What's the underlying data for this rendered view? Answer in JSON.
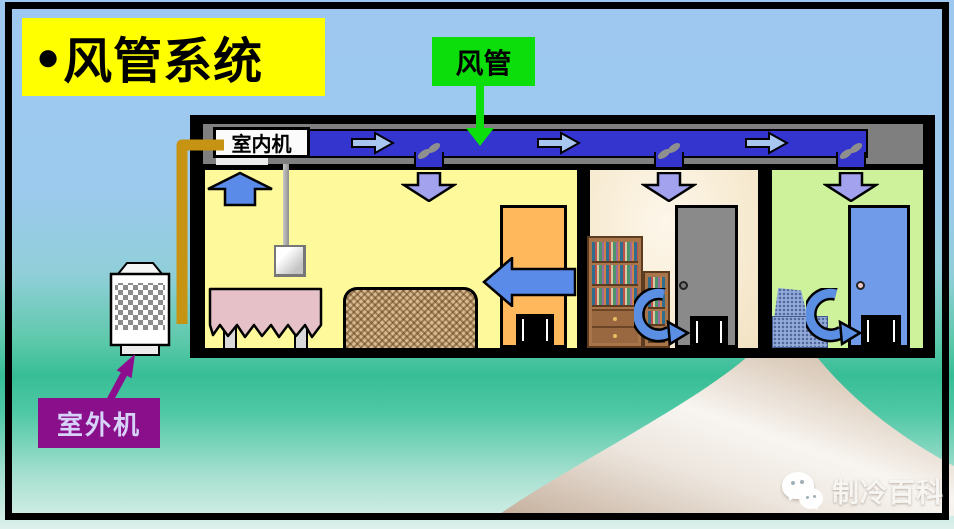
{
  "slide": {
    "title": {
      "bullet": "●",
      "text": "风管系统"
    },
    "callouts": {
      "duct": "风管",
      "indoor_unit": "室内机",
      "outdoor_unit": "室外机"
    },
    "watermark": "制冷百科",
    "icons": {
      "duct_airflow": "right-arrow",
      "supply_vent": "down-arrow",
      "return_air": "up-arrow",
      "room_return": "left-arrow",
      "door_airflow": "curved-arrow",
      "damper": "s-damper",
      "watermark_logo": "wechat-bubbles"
    },
    "colors": {
      "sky": "#9EC8F0",
      "ground_teal": "#37BE96",
      "title_bg": "#FFFF00",
      "duct_callout_bg": "#0BDE0B",
      "outdoor_callout_bg": "#8A0F8A",
      "outdoor_callout_text": "#D6D2FA",
      "duct_blue": "#3434CE",
      "ceiling_gray": "#7F7F7F",
      "room1_bg": "#FEF99B",
      "room2_bg": "#F7EBD2",
      "room3_bg": "#CEF29B",
      "pipe_gold": "#C79312",
      "arrow_blue": "#5A8BE8",
      "vent_arrow_lavender": "#A2A2EF",
      "duct_arrow_lightblue": "#A9C6F1",
      "road_tan": "#C8B19E"
    }
  }
}
